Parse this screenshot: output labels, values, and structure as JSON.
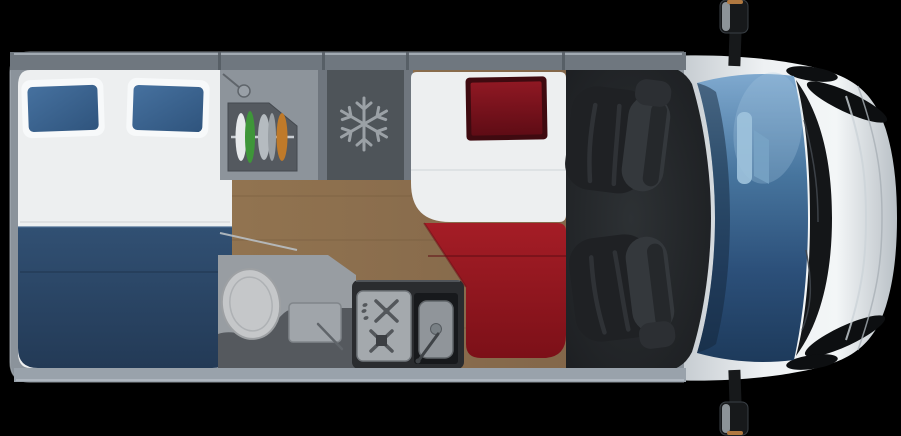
{
  "scene": {
    "description": "Top-down 3D rendered floor plan of a campervan: rear transverse double bed with blue pillows, wardrobe, freezer cabinet, single bed with red pillow and red mattress, bathroom with toilet and washbasin, kitchen with two-burner hob and sink, two swivelled cab seats, windshield and front hood"
  },
  "icons": {
    "freezer_glyph": "snowflake"
  },
  "colors": {
    "background": "#000000",
    "wall": "#8b939b",
    "wall_band": "#6f777f",
    "wall_band_light": "#bcc4cb",
    "bottom_band": "#99a2ab",
    "divider": "#6f767e",
    "wood_light": "#927450",
    "wood": "#83674a",
    "wood_dark": "#6f5639",
    "bed_white": "#edeff0",
    "pillow_case": "#f7f9fa",
    "pillow_blue_light": "#46719f",
    "pillow_blue_dark": "#2f547d",
    "blanket_top": "#315073",
    "blanket_bottom": "#233a56",
    "wardrobe_panel": "#8d949b",
    "wardrobe_inner": "#54595f",
    "rail": "#c9ced3",
    "cloth_white": "#e6e9eb",
    "cloth_green": "#3e9639",
    "cloth_silver": "#b5bbc0",
    "cloth_orange": "#bf7a2a",
    "fridge": "#4e5459",
    "snowflake": "#9ba1a6",
    "bath_floor": "#989da2",
    "bath_dark": "#55595e",
    "toilet": "#c5c7c9",
    "basin": "#a0a5aa",
    "counter": "#2a2c2f",
    "hob": "#a4a9ad",
    "burner": "#53575b",
    "sink_recess": "#17191c",
    "sink_basin": "#90959a",
    "red_pillow": "#8f1823",
    "red_pillow_dark": "#5f0c15",
    "red_pillow_edge": "#3f0a10",
    "mattress_red_top": "#a51d26",
    "mattress_red_bottom": "#7c1018",
    "cab_floor_center": "#2d3134",
    "cab_floor_edge": "#1b1d20",
    "seat_cushion": "#1f2124",
    "seat_back": "#34383c",
    "windshield_top": "#7fa9cf",
    "windshield_mid1": "#47759e",
    "windshield_mid2": "#2c507a",
    "windshield_bottom": "#1d3a5b",
    "interior_mirror": "#9fc3dd",
    "hood_edge": "#b9c0c6",
    "hood_light": "#eef1f3",
    "hood_bright": "#f3f6f7",
    "grille": "#141618",
    "slit": "#0d0f11",
    "mirror_body": "#17191b",
    "mirror_tip": "#b07840"
  }
}
